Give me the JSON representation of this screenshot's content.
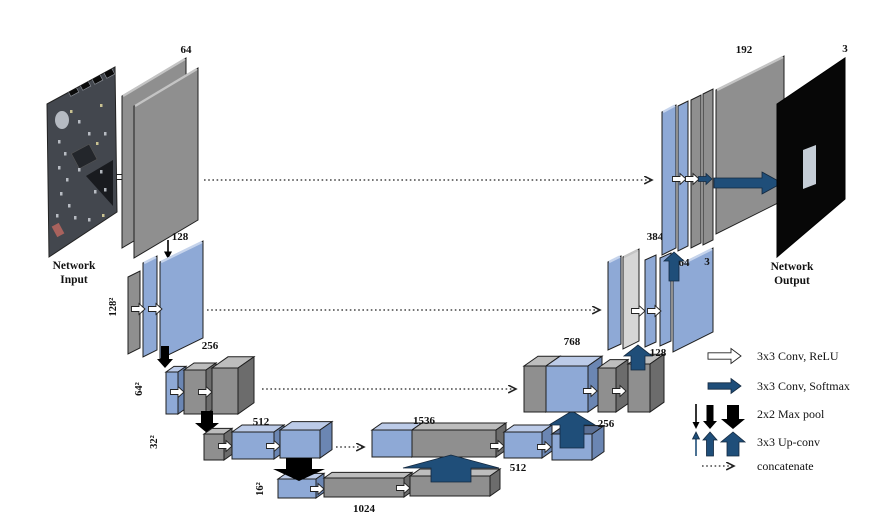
{
  "figure": {
    "type": "neural-network-architecture-diagram",
    "input_caption": {
      "line1": "Network",
      "line2": "Input"
    },
    "output_caption": {
      "line1": "Network",
      "line2": "Output"
    },
    "layer_labels": {
      "enc1": "64",
      "enc2": "128",
      "enc3": "256",
      "enc4": "512",
      "bottleneck": "1024",
      "dec4_concat": "1536",
      "dec4": "512",
      "dec3_concat": "768",
      "dec3_up": "256",
      "dec2_up": "128",
      "dec2_concat": "384",
      "dec2_a": "64",
      "dec2_b": "3",
      "dec1": "192",
      "output_channels": "3"
    },
    "resolution_labels": {
      "r128": "128²",
      "r64": "64²",
      "r32": "32²",
      "r16": "16²"
    },
    "legend": {
      "items": [
        {
          "icon": "conv-relu-arrow-icon",
          "label": "3x3 Conv, ReLU"
        },
        {
          "icon": "conv-softmax-arrow-icon",
          "label": "3x3 Conv, Softmax"
        },
        {
          "icon": "max-pool-arrow-icon",
          "label": "2x2 Max pool"
        },
        {
          "icon": "up-conv-arrow-icon",
          "label": "3x3 Up-conv"
        },
        {
          "icon": "concatenate-arrow-icon",
          "label": "concatenate"
        }
      ]
    },
    "colors": {
      "feature_map_blue": "#8EA9D6",
      "feature_map_gray": "#8F8F8F",
      "concat_lightgray": "#D6D6D6",
      "arrow_navy": "#1F4E79",
      "arrow_black": "#000000",
      "background": "#FFFFFF"
    }
  }
}
